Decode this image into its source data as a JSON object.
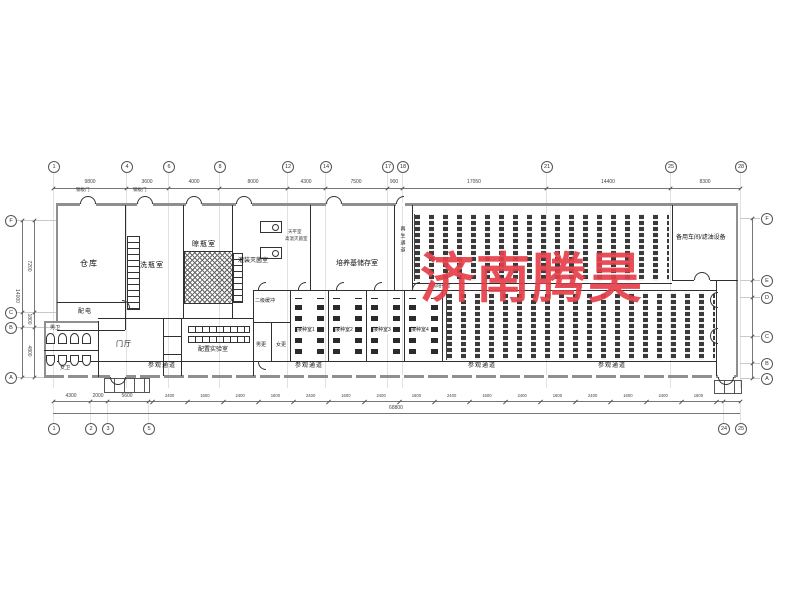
{
  "watermark": {
    "text": "济南腾昊",
    "color": "#e5404a"
  },
  "rooms": {
    "warehouse": "仓库",
    "bottle_wash": "洗瓶室",
    "bottle_dry": "晾瓶室",
    "filling_sterilization": "灌装灭菌室",
    "balance_room": "天平室",
    "autoclave_room": "高温灭菌室",
    "medium_storage": "培养基储存室",
    "regen_corridor": "再生通道",
    "light_culture": "光照培养室",
    "spare_workshop": "备用车间/滤油设备",
    "power_room": "配电",
    "entrance_hall": "门厅",
    "mens_wc": "男卫",
    "womens_wc": "女卫",
    "prep_lab": "配置实验室",
    "secondary_buffer": "二级缓冲",
    "mens_changing": "男更",
    "womens_changing": "女更",
    "inoculation_room_1": "接种室1",
    "inoculation_room_2": "接种室2",
    "inoculation_room_3": "接种室3",
    "inoculation_room_4": "接种室4",
    "visitor_corridor": "参观通道",
    "steel_door": "钢板门"
  },
  "grid": {
    "top": [
      "1",
      "4",
      "6",
      "8",
      "12",
      "14",
      "17",
      "18",
      "21",
      "25",
      "28"
    ],
    "bottom": [
      "1",
      "2",
      "3",
      "5",
      "24",
      "25"
    ],
    "left": [
      "F",
      "C",
      "B",
      "A"
    ],
    "right": [
      "F",
      "E",
      "D",
      "C",
      "B",
      "A"
    ]
  },
  "dimensions": {
    "top": [
      "9800",
      "3600",
      "4000",
      "8000",
      "4300",
      "7500",
      "900",
      "17050",
      "14400",
      "8300"
    ],
    "bottom_left": [
      "4300",
      "2000",
      "5600"
    ],
    "bottom_windows": [
      "2400",
      "1600",
      "2400",
      "1600",
      "2400",
      "1600",
      "2400",
      "1600",
      "2400",
      "1600",
      "2400",
      "1600",
      "2400",
      "1600",
      "2400",
      "1600"
    ],
    "bottom_total": "68800",
    "left": [
      "7200",
      "1800",
      "4800"
    ],
    "left_total": "14000"
  }
}
